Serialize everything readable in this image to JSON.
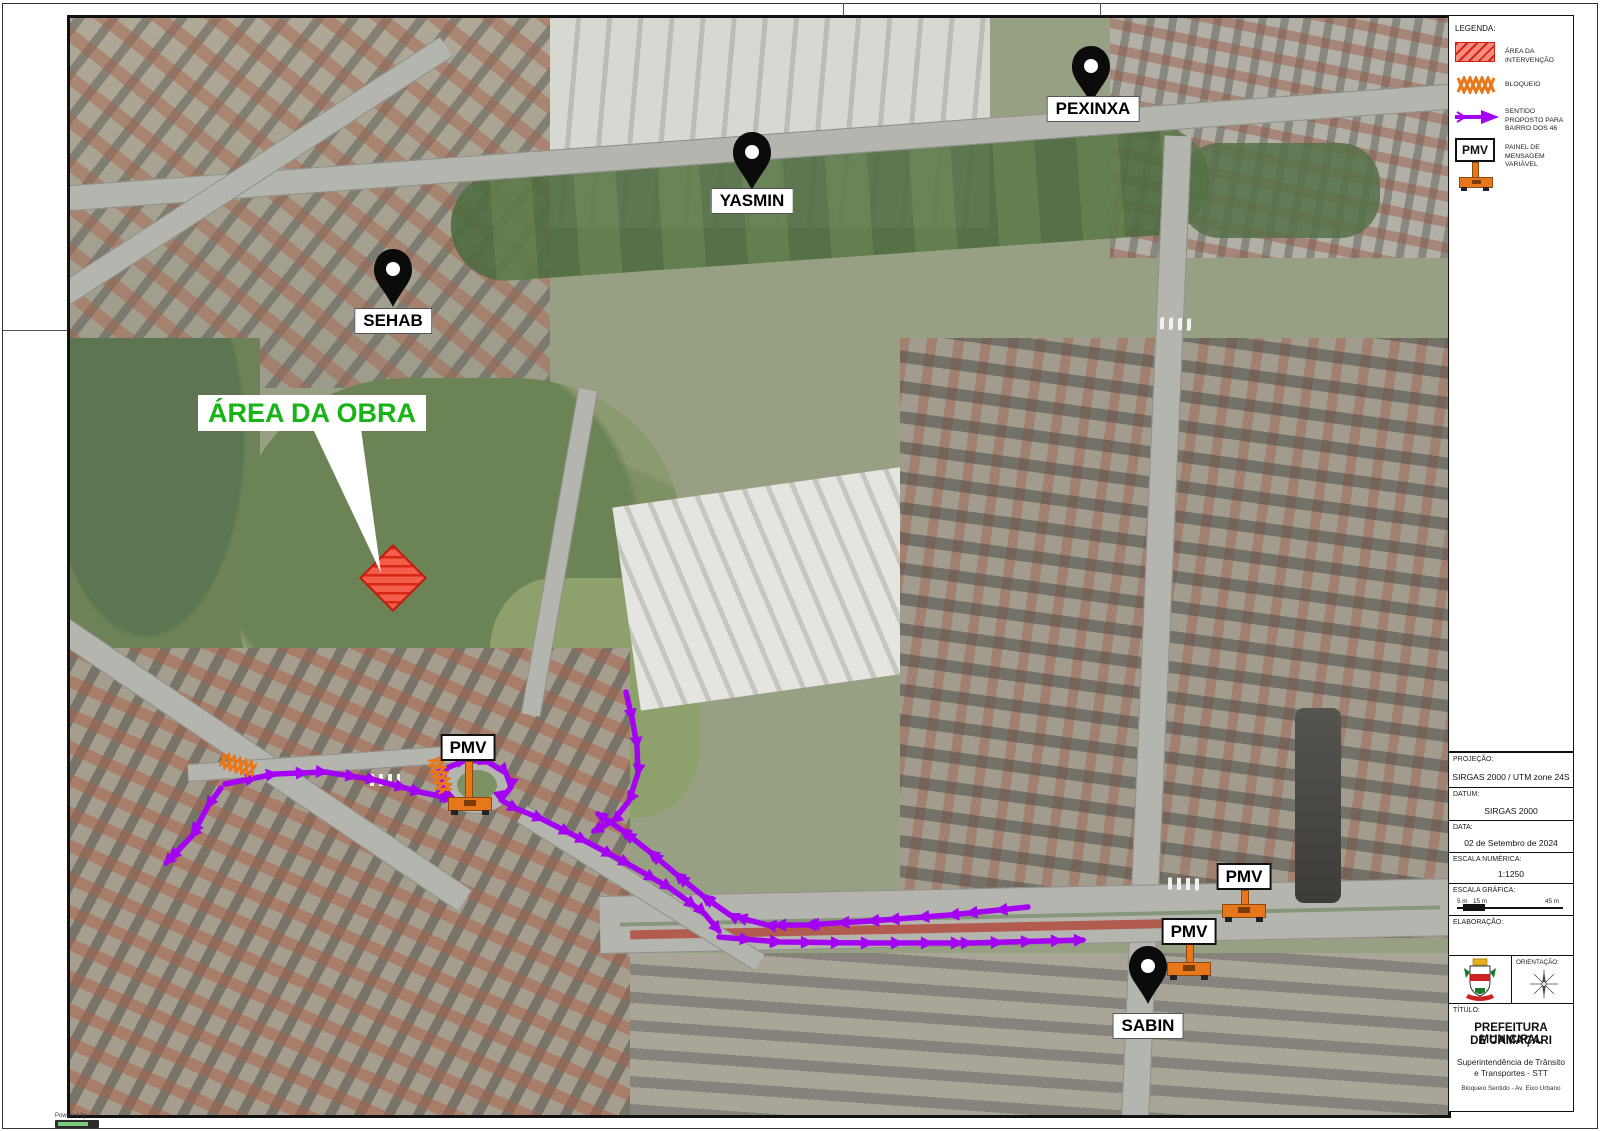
{
  "colors": {
    "route": "#a303f2",
    "blockade": "#e8761b",
    "area_fill": "#ff5a4a",
    "area_stroke": "#c21507",
    "label_green": "#18b415"
  },
  "legend": {
    "title": "LEGENDA:",
    "items": [
      {
        "icon": "area-intervention-swatch",
        "label": "ÁREA DA INTERVENÇÃO"
      },
      {
        "icon": "blockade-swatch",
        "label": "BLOQUEIO"
      },
      {
        "icon": "direction-arrow-swatch",
        "label": "SENTIDO PROPOSTO PARA BAIRRO DOS 46"
      },
      {
        "icon": "pmv-swatch",
        "label": "PAINEL DE MENSAGEM VARIÁVEL",
        "swatch_text": "PMV"
      }
    ]
  },
  "map": {
    "area_label": "ÁREA DA OBRA",
    "pins": [
      {
        "id": "pexinxa",
        "label": "PEXINXA"
      },
      {
        "id": "yasmin",
        "label": "YASMIN"
      },
      {
        "id": "sehab",
        "label": "SEHAB"
      },
      {
        "id": "sabin",
        "label": "SABIN"
      }
    ],
    "pmv_markers": [
      {
        "label": "PMV"
      },
      {
        "label": "PMV"
      },
      {
        "label": "PMV"
      }
    ],
    "attribution": "Powered by"
  },
  "routes": [
    {
      "name": "west-exit",
      "points": [
        [
          151,
          770
        ],
        [
          138,
          788
        ],
        [
          122,
          818
        ],
        [
          96,
          845
        ]
      ]
    },
    {
      "name": "west-approach",
      "points": [
        [
          155,
          766
        ],
        [
          205,
          756
        ],
        [
          255,
          754
        ],
        [
          305,
          762
        ],
        [
          350,
          774
        ],
        [
          383,
          781
        ]
      ]
    },
    {
      "name": "pmv-loop",
      "points": [
        [
          383,
          781
        ],
        [
          370,
          766
        ],
        [
          377,
          750
        ],
        [
          396,
          742
        ],
        [
          418,
          744
        ],
        [
          436,
          755
        ],
        [
          441,
          769
        ],
        [
          431,
          782
        ],
        [
          447,
          791
        ],
        [
          472,
          801
        ]
      ]
    },
    {
      "name": "diagonal-southeast",
      "points": [
        [
          472,
          801
        ],
        [
          515,
          823
        ],
        [
          558,
          846
        ],
        [
          600,
          870
        ],
        [
          634,
          895
        ],
        [
          649,
          913
        ]
      ]
    },
    {
      "name": "eastbound-main",
      "points": [
        [
          649,
          919
        ],
        [
          710,
          924
        ],
        [
          800,
          925
        ],
        [
          900,
          925
        ],
        [
          1013,
          922
        ]
      ]
    },
    {
      "name": "westbound-main",
      "points": [
        [
          958,
          889
        ],
        [
          880,
          897
        ],
        [
          800,
          903
        ],
        [
          737,
          907
        ],
        [
          697,
          907
        ],
        [
          660,
          897
        ],
        [
          633,
          878
        ],
        [
          606,
          856
        ],
        [
          580,
          834
        ],
        [
          552,
          812
        ],
        [
          528,
          796
        ]
      ]
    },
    {
      "name": "north-descent",
      "points": [
        [
          556,
          674
        ],
        [
          562,
          700
        ],
        [
          567,
          728
        ],
        [
          568,
          755
        ],
        [
          559,
          783
        ],
        [
          543,
          803
        ],
        [
          524,
          813
        ]
      ]
    }
  ],
  "info_rows": [
    {
      "label": "PROJEÇÃO:",
      "value": "SIRGAS 2000 / UTM zone 24S"
    },
    {
      "label": "DATUM:",
      "value": "SIRGAS 2000"
    },
    {
      "label": "DATA:",
      "value": "02 de Setembro de 2024"
    },
    {
      "label": "ESCALA NUMÉRICA:",
      "value": "1:1250"
    }
  ],
  "scale_bar": {
    "label": "ESCALA GRÁFICA:",
    "left": "5 m",
    "mid": "15 m",
    "right": "45 m"
  },
  "elaboracao_label": "ELABORAÇÃO:",
  "orientation_label": "ORIENTAÇÃO:",
  "title_block": {
    "label": "TÍTULO:",
    "line1": "PREFEITURA MUNICIPAL",
    "line2": "DE CAMAÇARI",
    "sub1": "Superintendência de Trânsito",
    "sub2": "e Transportes - STT",
    "sub3": "Bloqueio Sentido - Av. Eixo Urbano"
  }
}
